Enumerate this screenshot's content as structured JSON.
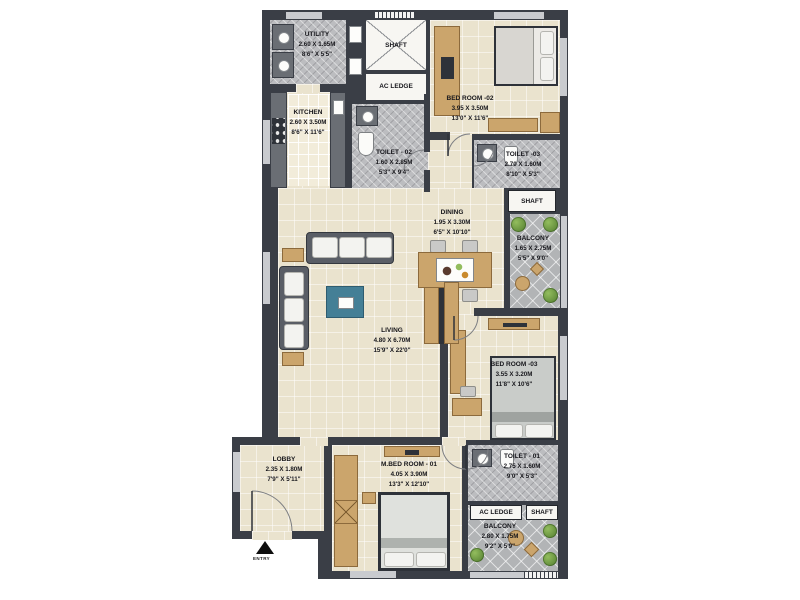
{
  "labels": {
    "entry": "ENTRY"
  },
  "rooms": {
    "utility": {
      "name": "UTILITY",
      "dim_m": "2.60 X 1.65M",
      "dim_ft": "8'6\" X 5'5\""
    },
    "kitchen": {
      "name": "KITCHEN",
      "dim_m": "2.60 X 3.50M",
      "dim_ft": "8'6\" X 11'6\""
    },
    "shaft_top": {
      "name": "SHAFT"
    },
    "ac_ledge_top": {
      "name": "AC LEDGE"
    },
    "bedroom2": {
      "name": "BED ROOM -02",
      "dim_m": "3.95 X 3.50M",
      "dim_ft": "13'0\" X 11'6\""
    },
    "toilet2": {
      "name": "TOILET - 02",
      "dim_m": "1.60 X 2.85M",
      "dim_ft": "5'3\" X 9'4\""
    },
    "toilet3": {
      "name": "TOILET -03",
      "dim_m": "2.70 X 1.60M",
      "dim_ft": "8'10\" X 5'3\""
    },
    "shaft_right": {
      "name": "SHAFT"
    },
    "balcony_right": {
      "name": "BALCONY",
      "dim_m": "1.65 X 2.75M",
      "dim_ft": "5'5\" X 9'0\""
    },
    "dining": {
      "name": "DINING",
      "dim_m": "1.95 X 3.30M",
      "dim_ft": "6'5\" X 10'10\""
    },
    "living": {
      "name": "LIVING",
      "dim_m": "4.80 X 6.70M",
      "dim_ft": "15'9\" X 22'0\""
    },
    "bedroom3": {
      "name": "BED ROOM -03",
      "dim_m": "3.55 X 3.20M",
      "dim_ft": "11'8\" X 10'6\""
    },
    "lobby": {
      "name": "LOBBY",
      "dim_m": "2.35 X 1.80M",
      "dim_ft": "7'9\" X 5'11\""
    },
    "master_bedroom": {
      "name": "M.BED ROOM - 01",
      "dim_m": "4.05 X 3.90M",
      "dim_ft": "13'3\" X 12'10\""
    },
    "toilet1": {
      "name": "TOILET - 01",
      "dim_m": "2.75 X 1.60M",
      "dim_ft": "9'0\" X 5'3\""
    },
    "ac_ledge_bottom": {
      "name": "AC LEDGE"
    },
    "shaft_bottom": {
      "name": "SHAFT"
    },
    "balcony_bottom": {
      "name": "BALCONY",
      "dim_m": "2.80 X 1.75M",
      "dim_ft": "9'2\" X 5'9\""
    }
  },
  "colors": {
    "wall": "#3a3e46",
    "floor": "#eae3ce",
    "wet_floor": "#bcbdc0",
    "balcony_floor": "#b2b4b6",
    "wood": "#cba56c",
    "rug": "#447f96",
    "plant": "#4f7a2d",
    "text": "#16161b"
  }
}
